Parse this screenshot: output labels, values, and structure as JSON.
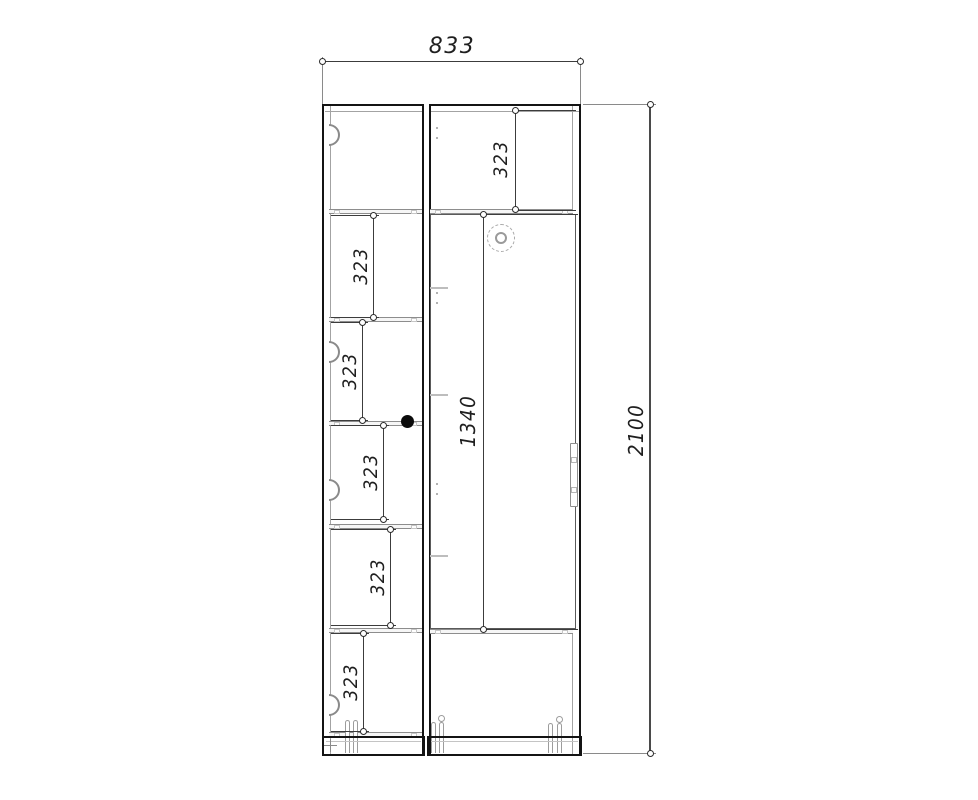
{
  "drawing": {
    "kind": "cabinet-front-elevation",
    "overall_width": "833",
    "overall_height": "2100",
    "door_height": "1340",
    "shelf_spacings": [
      "323",
      "323",
      "323",
      "323",
      "323",
      "323"
    ],
    "colors": {
      "background": "#ffffff",
      "outline": "#141414",
      "panel_line": "#9c9c9c",
      "dimension_line": "#3c3c3c",
      "text": "#1f1f1f"
    }
  }
}
